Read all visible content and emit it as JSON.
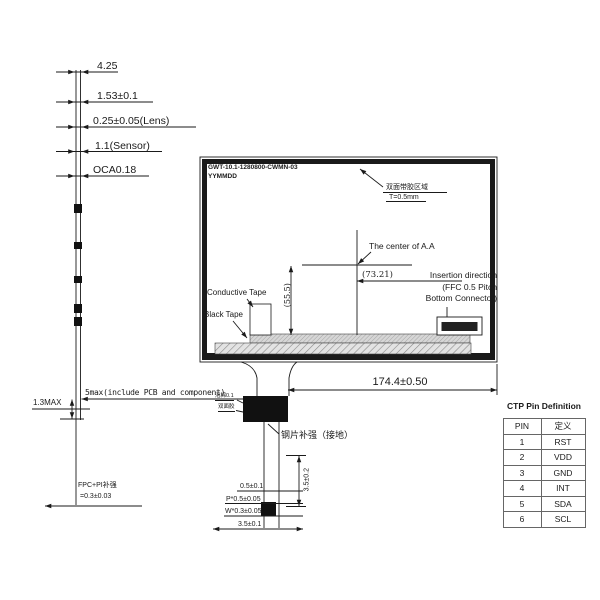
{
  "drawing": {
    "side_view": {
      "layer_labels": [
        "4.25",
        "1.53±0.1",
        "0.25±0.05(Lens)",
        "1.1(Sensor)",
        "OCA0.18"
      ],
      "thickness_note": "5max(include PCB and component)",
      "bottom_max": "1.3MAX",
      "fpc_note_line1": "FPC+PI补强",
      "fpc_note_line2": "=0.3±0.03"
    },
    "front_view": {
      "part_number": "GWT-10.1-1280800-CWMN-03",
      "date_code": "YYMMDD",
      "adhesive_note_line1": "双面带胶区域",
      "adhesive_note_line2": "T=0.5mm",
      "center_label": "The center of A.A",
      "dim_center_to_connector": "(73.21)",
      "insertion_note_line1": "Insertion direction",
      "insertion_note_line2": "(FFC 0.5 Pitch",
      "insertion_note_line3": "Bottom Connector)",
      "dim_vertical": "(55.5)",
      "conductive_tape_label": "Conductive Tape",
      "black_tape_label": "Black Tape",
      "dim_width": "174.4±0.50"
    },
    "fpc_tail": {
      "foam_label": "泡棉0.1",
      "adhesive_label": "双面胶",
      "stiffener_label": "钢片补强（接地）",
      "dim_length": "3.5±0.2",
      "dim_list": [
        "0.5±0.1",
        "P*0.5±0.05",
        "W*0.3±0.05",
        "3.5±0.1"
      ]
    },
    "pin_table": {
      "title": "CTP Pin Definition",
      "headers": [
        "PIN",
        "定义"
      ],
      "rows": [
        [
          "1",
          "RST"
        ],
        [
          "2",
          "VDD"
        ],
        [
          "3",
          "GND"
        ],
        [
          "4",
          "INT"
        ],
        [
          "5",
          "SDA"
        ],
        [
          "6",
          "SCL"
        ]
      ]
    },
    "colors": {
      "line": "#1a1a1a",
      "background": "#ffffff",
      "hatch_fill": "#e0e0e0"
    }
  }
}
